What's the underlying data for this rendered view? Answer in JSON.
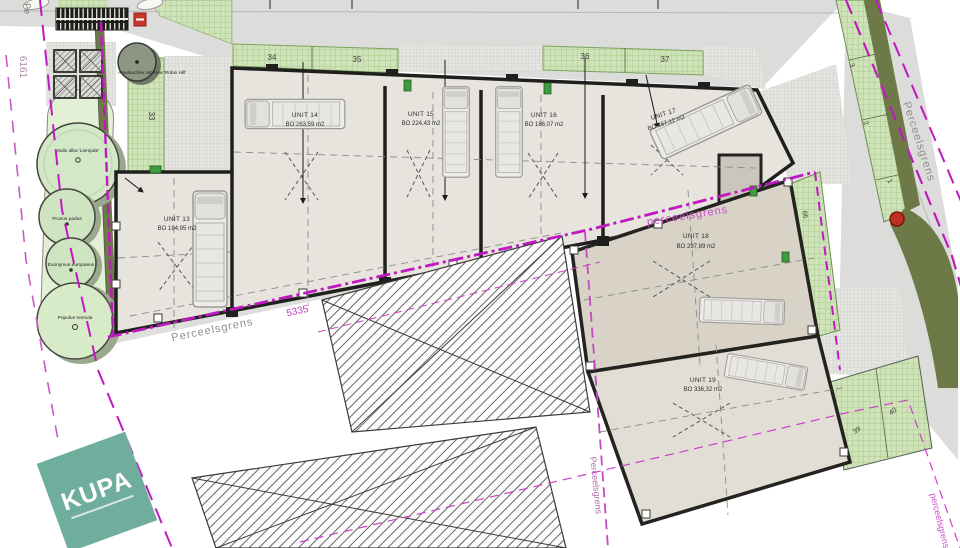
{
  "units": {
    "u13": {
      "name": "UNIT 13",
      "area": "BO 194,95 m2"
    },
    "u14": {
      "name": "UNIT 14",
      "area": "BO 263,59 m2"
    },
    "u15": {
      "name": "UNIT 15",
      "area": "BO 224,43 m2"
    },
    "u16": {
      "name": "UNIT 16",
      "area": "BO 186,07 m2"
    },
    "u17": {
      "name": "UNIT 17",
      "area": "BO 167,12 m2"
    },
    "u18": {
      "name": "UNIT 18",
      "area": "BO 297,89 m2"
    },
    "u19": {
      "name": "UNIT 19",
      "area": "BO 336,32 m2"
    }
  },
  "dims": {
    "n33": "33",
    "n34": "34",
    "n35": "35",
    "n36": "36",
    "n37": "37",
    "n39": "39",
    "n40": "40",
    "n66": "66",
    "n6161": "6161",
    "n5335": "5335",
    "c1": "1",
    "c2": "2",
    "c3": "3"
  },
  "labels": {
    "perceelsgrens_bottom": "Perceelsgrens",
    "perceelsgrens_mid": "perceelsgrens",
    "perceelsgrens_right": "Perceelsgrens",
    "perceelsgrens_center": "Perceelsgrens",
    "perceelsgrens_corner": "perceelsgrens",
    "pe_partial": "Pe"
  },
  "plants": {
    "amelanchier": "Amelanchier arborea 'Robin Hill'",
    "salix": "Salix alba 'Liempde'",
    "prunus": "Prunus padus",
    "euonymus": "Euonymus europaeus",
    "populus": "Populus tremula"
  },
  "logo": {
    "text": "KUPA"
  },
  "colors": {
    "boundary_magenta": "#c118c1",
    "wall_black": "#1f1f1d",
    "green_grid": "#cfe3b8",
    "olive": "#6d7a48",
    "road_gray": "#dcdcda",
    "unit_floor": "#e7e4dd",
    "logo_teal": "#6fae9d"
  }
}
